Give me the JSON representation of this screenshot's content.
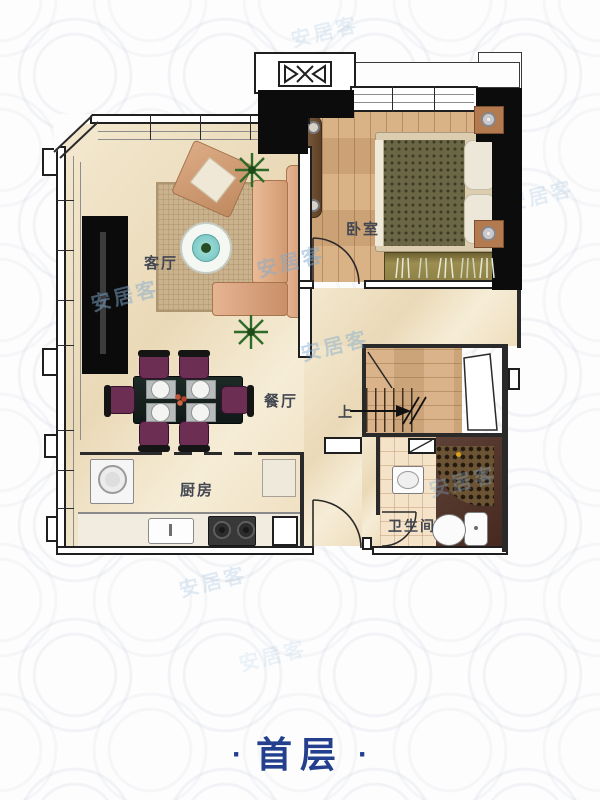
{
  "watermark": {
    "text": "安居客",
    "color": "#7fabd0"
  },
  "title": {
    "dot": "·",
    "text": "首层",
    "color": "#233f8e"
  },
  "rooms": {
    "living_room": {
      "label": "客厅"
    },
    "bedroom": {
      "label": "卧室"
    },
    "dining_room": {
      "label": "餐厅"
    },
    "kitchen": {
      "label": "厨房"
    },
    "bathroom": {
      "label": "卫生间"
    },
    "stairs": {
      "label": "上"
    }
  },
  "colors": {
    "wall": "#0c0c0c",
    "wood_floor": "#d6ab7c",
    "marble_floor": "#efe2c8",
    "accent_blue": "#233f8e",
    "watermark_blue": "#7fabd0"
  }
}
